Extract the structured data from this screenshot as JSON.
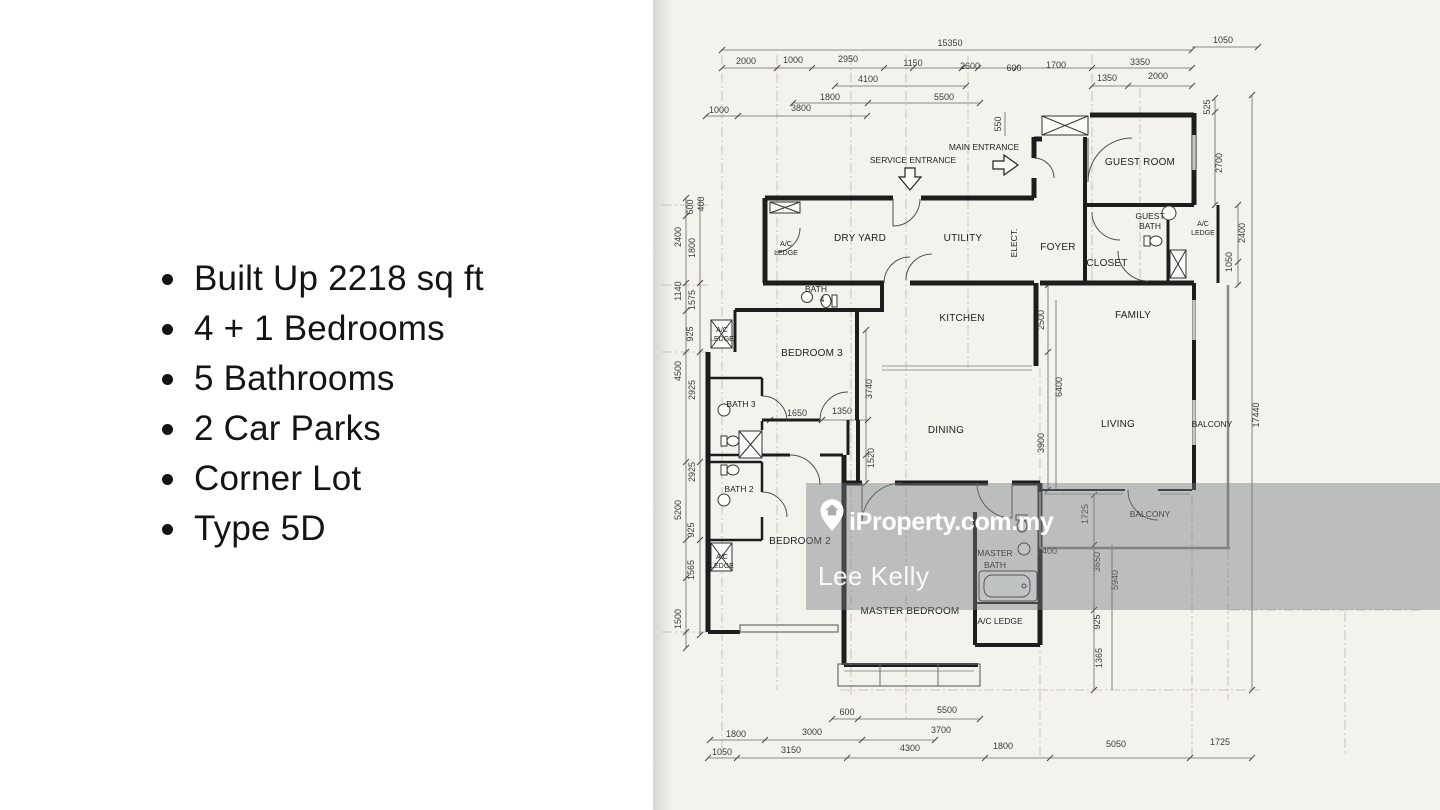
{
  "listing": {
    "bullets": [
      "Built Up 2218 sq ft",
      "4 + 1 Bedrooms",
      "5 Bathrooms",
      "2 Car Parks",
      "Corner Lot",
      "Type 5D"
    ]
  },
  "watermark": {
    "brand": "iProperty.com.my",
    "agent": "Lee Kelly",
    "icon": "location-pin-house-icon"
  },
  "floorplan": {
    "entrances": {
      "service": "SERVICE ENTRANCE",
      "main": "MAIN ENTRANCE"
    },
    "rooms": {
      "guest_room": "GUEST ROOM",
      "guest_bath_1": "GUEST",
      "guest_bath_2": "BATH",
      "ac_guest_1": "A/C",
      "ac_guest_2": "LEDGE",
      "dry_yard": "DRY YARD",
      "utility": "UTILITY",
      "elect": "ELECT.",
      "foyer": "FOYER",
      "closet": "CLOSET",
      "ac_dry_1": "A/C",
      "ac_dry_2": "LEDGE",
      "bath4_1": "BATH",
      "bath4_2": "4",
      "kitchen": "KITCHEN",
      "family": "FAMILY",
      "bedroom3": "BEDROOM 3",
      "ac_b3_1": "A/C",
      "ac_b3_2": "LEDGE",
      "bath3": "BATH 3",
      "bath2": "BATH 2",
      "ac_b2_1": "A/C",
      "ac_b2_2": "LEDGE",
      "bedroom2": "BEDROOM 2",
      "dining": "DINING",
      "living": "LIVING",
      "balcony_side": "BALCONY",
      "balcony_bottom": "BALCONY",
      "master_bath_1": "MASTER",
      "master_bath_2": "BATH",
      "master_bedroom": "MASTER BEDROOM",
      "ac_master": "A/C LEDGE"
    },
    "dims": {
      "top1": [
        "15350",
        "1050"
      ],
      "top2": [
        "2000",
        "1000",
        "2950",
        "1150",
        "2600",
        "600",
        "1700",
        "3350"
      ],
      "top3": [
        "4100",
        "1350",
        "2000"
      ],
      "top4": [
        "1800",
        "5500"
      ],
      "top5": [
        "1000",
        "3800"
      ],
      "top_v": [
        "550",
        "525"
      ],
      "left": [
        "600",
        "400",
        "2400",
        "1800",
        "1140",
        "1575",
        "925",
        "4500",
        "2925",
        "2925",
        "5200",
        "925",
        "1565",
        "1500"
      ],
      "right": [
        "2700",
        "2400",
        "1050",
        "17440"
      ],
      "inner_v": [
        "2500",
        "6400",
        "3900",
        "3740",
        "1520",
        "1725",
        "3650",
        "5940",
        "925",
        "1365"
      ],
      "inner_h": [
        "1650",
        "1350",
        "1400"
      ],
      "bottom1": [
        "600",
        "5500"
      ],
      "bottom2": [
        "1800",
        "3000",
        "3700"
      ],
      "bottom3": [
        "1050",
        "3150",
        "4300",
        "1800",
        "5050",
        "1725"
      ]
    }
  }
}
